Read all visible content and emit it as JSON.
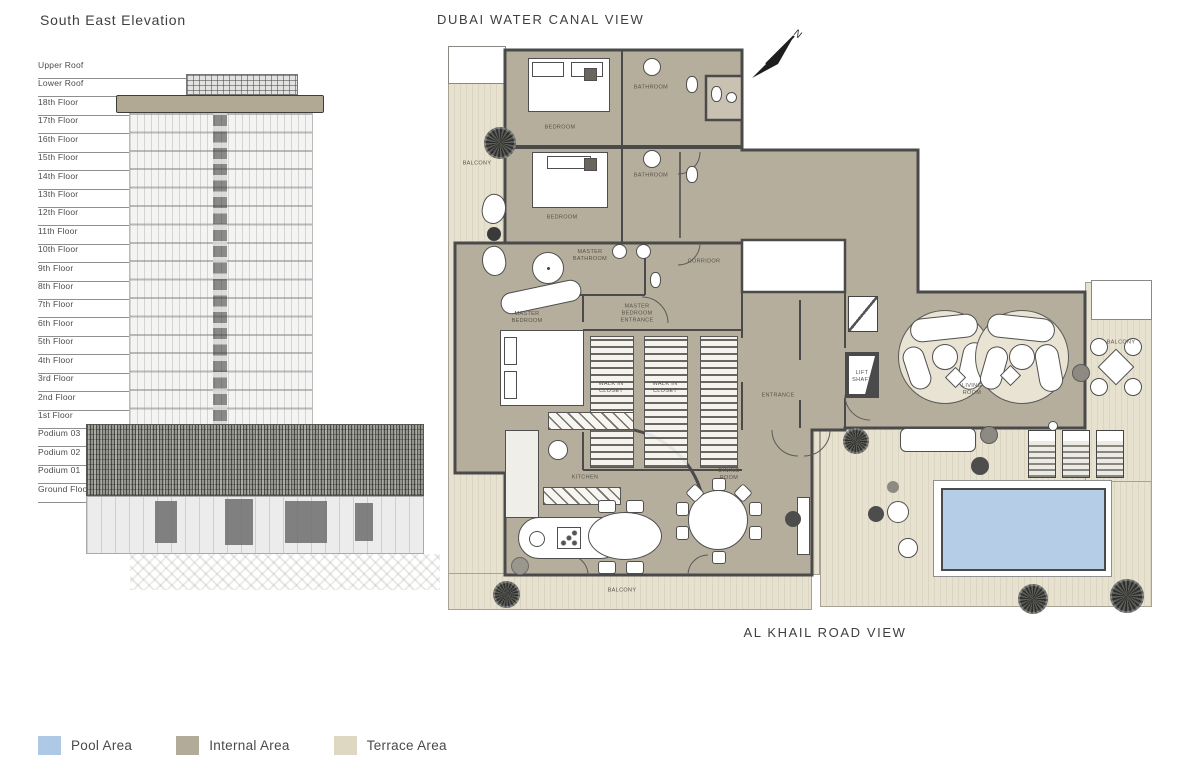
{
  "elevation": {
    "title": "South East Elevation",
    "floors": [
      "Upper Roof",
      "Lower Roof",
      "18th Floor",
      "17th Floor",
      "16th Floor",
      "15th Floor",
      "14th Floor",
      "13th Floor",
      "12th Floor",
      "11th Floor",
      "10th Floor",
      "9th Floor",
      "8th Floor",
      "7th Floor",
      "6th Floor",
      "5th Floor",
      "4th Floor",
      "3rd Floor",
      "2nd Floor",
      "1st Floor",
      "Podium 03",
      "Podium 02",
      "Podium 01",
      "Ground Floor"
    ]
  },
  "plan": {
    "top_view_label": "DUBAI WATER CANAL VIEW",
    "bottom_view_label": "AL KHAIL ROAD VIEW",
    "north_label": "N",
    "rooms": [
      {
        "id": "bedroom-1",
        "label": "BEDROOM"
      },
      {
        "id": "bathroom-1",
        "label": "BATHROOM"
      },
      {
        "id": "bedroom-2",
        "label": "BEDROOM"
      },
      {
        "id": "bathroom-2",
        "label": "BATHROOM"
      },
      {
        "id": "master-bathroom",
        "label": "MASTER BATHROOM"
      },
      {
        "id": "corridor",
        "label": "CORRIDOR"
      },
      {
        "id": "master-bedroom",
        "label": "MASTER BEDROOM"
      },
      {
        "id": "master-bedroom-entrance",
        "label": "MASTER BEDROOM ENTRANCE"
      },
      {
        "id": "walk-in-closet-1",
        "label": "WALK IN CLOSET"
      },
      {
        "id": "walk-in-closet-2",
        "label": "WALK IN CLOSET"
      },
      {
        "id": "entrance",
        "label": "ENTRANCE"
      },
      {
        "id": "lift-shaft",
        "label": "LIFT SHAFT"
      },
      {
        "id": "living-room",
        "label": "LIVING ROOM"
      },
      {
        "id": "kitchen",
        "label": "KITCHEN"
      },
      {
        "id": "dining-room",
        "label": "DINING ROOM"
      },
      {
        "id": "balcony-left",
        "label": "BALCONY"
      },
      {
        "id": "balcony-bottom",
        "label": "BALCONY"
      },
      {
        "id": "balcony-right",
        "label": "BALCONY"
      }
    ]
  },
  "legend": {
    "items": [
      {
        "id": "pool-area",
        "label": "Pool Area",
        "color": "#aec9e6"
      },
      {
        "id": "internal-area",
        "label": "Internal Area",
        "color": "#b3ab99"
      },
      {
        "id": "terrace-area",
        "label": "Terrace Area",
        "color": "#ded8c3"
      }
    ]
  },
  "colors": {
    "internal": "#b6ae9c",
    "terrace": "#e7e1cf",
    "terrace_stripe": "#dcd5c1",
    "pool": "#b6cde7",
    "wall": "#4a4a4a"
  }
}
